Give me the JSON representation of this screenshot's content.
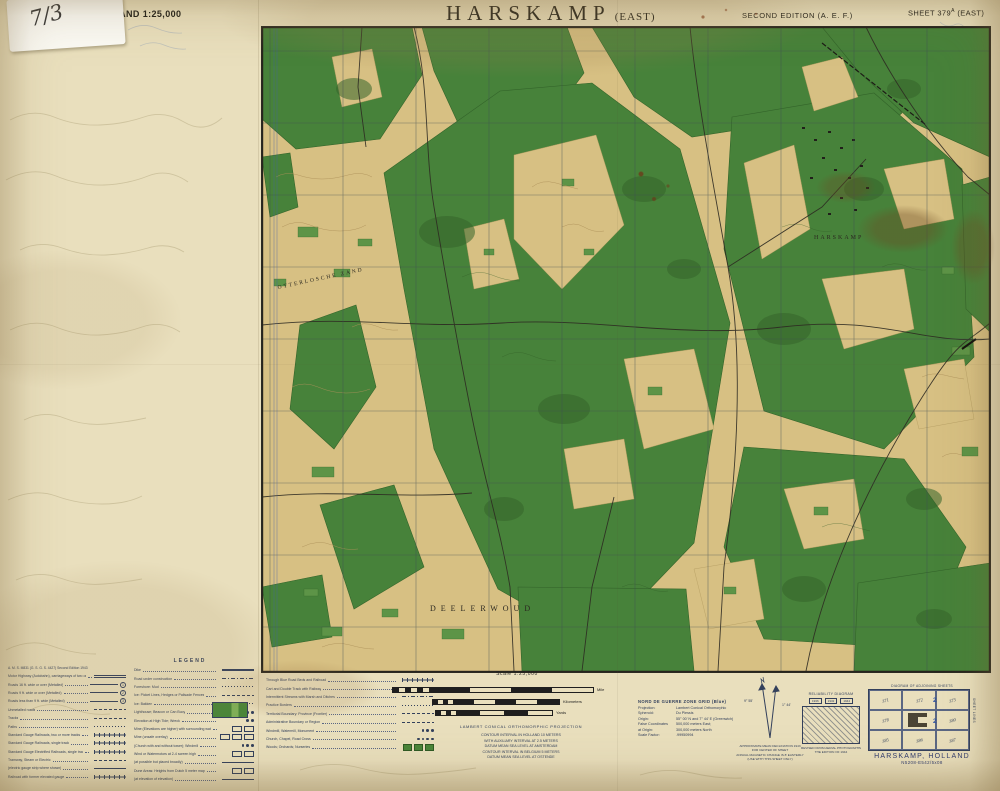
{
  "page": {
    "series_label": "HOLLAND 1:25,000",
    "title": "HARSKAMP",
    "title_suffix": "(EAST)",
    "edition": "SECOND EDITION (A. E. F.)",
    "sheet_prefix": "SHEET 379",
    "sheet_sup": "A",
    "sheet_suffix": "(EAST)",
    "sticker_note": "7/3"
  },
  "map_labels": {
    "deelerwoud": "DEELERWOUD",
    "otterlosche": "OTTERLOSCHE ZAND",
    "harskamp": "HARSKAMP"
  },
  "legend": {
    "title": "LEGEND",
    "left_header": "A. M. S. M831 (G. S. G. S. 4427) Second Edition 1943",
    "circles": [
      "1",
      "2",
      "3"
    ],
    "left": [
      "Motor Highway (Autobahn), carriageways of two or more lanes, hard surface",
      "Roads 16 ft. wide or over (Metalled)",
      "Roads 9 ft. wide or over (Metalled)",
      "Roads less than 9 ft. wide (Metalled)",
      "Unmetalled roads",
      "Tracks",
      "Paths",
      "Standard Gauge Railroads, two or more tracks",
      "Standard Gauge Railroads, single track",
      "Standard Gauge Electrified Railroads, single track",
      "Tramway, Steam or Electric",
      "(electric gauge strip where shown)",
      "Railroad with former elevated gauge"
    ],
    "right": [
      "Dike",
      "Road under construction",
      "Foreshore: Mud",
      "Ice: Picket Lines, Hedges or Palisade Fences",
      "Ice: Bakken",
      "Lighthouse; Beacon or Can Buoy",
      "Elevation at High Tide; Wreck",
      "Mine (Elevations are higher) with surrounding water",
      "Mine (unsafe overlay)",
      "(Church with and without tower); Windmill",
      "Wind or Watermotors at 2-4 screen high",
      "(at possible but placed broadly)",
      "Dune Areas: Heights from Dutch 5 meter map",
      "(at elevation of elevation)"
    ]
  },
  "symbols_block": [
    "Through Blue Road Beds and Railroad",
    "Cart and Double Track with Railway",
    "Intermittent Streams with Marsh and Ditches",
    "Practice Borders",
    "Territorial Boundary: Province (Frontier)",
    "Administrative Boundary or Region",
    "Windmill, Watermill, Monument",
    "Church, Chapel, Road Cross",
    "Woods; Orchards; Nurseries"
  ],
  "scale": {
    "label": "Scale 1:25,000",
    "mile": "Mile",
    "kilometers": "Kilometers",
    "yards": "Yards",
    "projection": "LAMBERT CONICAL ORTHOMORPHIC PROJECTION",
    "notes": [
      "CONTOUR INTERVAL IN HOLLAND 10 METERS",
      "WITH AUXILIARY INTERVAL AT 2.5 METERS",
      "DATUM MEAN SEA LEVEL AT AMSTERDAM",
      "CONTOUR INTERVAL IN BELGIUM 5 METERS",
      "DATUM MEAN SEA LEVEL AT OSTENDE"
    ]
  },
  "grid_info": {
    "title": "NORD DE GUERRE ZONE GRID (Blue)",
    "rows": [
      {
        "label": "Projection:",
        "value": "Lambert Conical Orthomorphic"
      },
      {
        "label": "Spheroid:",
        "value": "Du Plessis"
      },
      {
        "label": "Origin:",
        "value": "55° 00' N and 7° 44' E (Greenwich)"
      },
      {
        "label": "False Coordinates",
        "value": "500,000 meters East;"
      },
      {
        "label": "at Origin:",
        "value": "300,000 meters North"
      },
      {
        "label": "Scale Factor:",
        "value": ".99950994"
      }
    ]
  },
  "declination": {
    "left_value": "9° 55'",
    "right_value": "1° 44'",
    "caption": [
      "APPROXIMATE MEAN DECLINATION 1943",
      "FOR CENTER OF SHEET",
      "ANNUAL MAGNETIC CHANGE IS 8' EASTERLY",
      "(USE WITH THIS SHEET ONLY)"
    ]
  },
  "reliability": {
    "title": "RELIABILITY DIAGRAM",
    "boxes": [
      "1936",
      "1932",
      "1944"
    ],
    "caption": [
      "REVISED FROM AERIAL PHOTOGRAPHS",
      "THE EDITION OF 1944"
    ]
  },
  "index": {
    "title": "DIAGRAM OF ADJOINING SHEETS",
    "cells": [
      "371",
      "372",
      "373",
      "378",
      "379",
      "380",
      "385",
      "386",
      "387"
    ],
    "marker": "2",
    "side_label": "SHEET LINES"
  },
  "footer": {
    "title": "HARSKAMP, HOLLAND",
    "code": "N5208-E542/5x08"
  }
}
